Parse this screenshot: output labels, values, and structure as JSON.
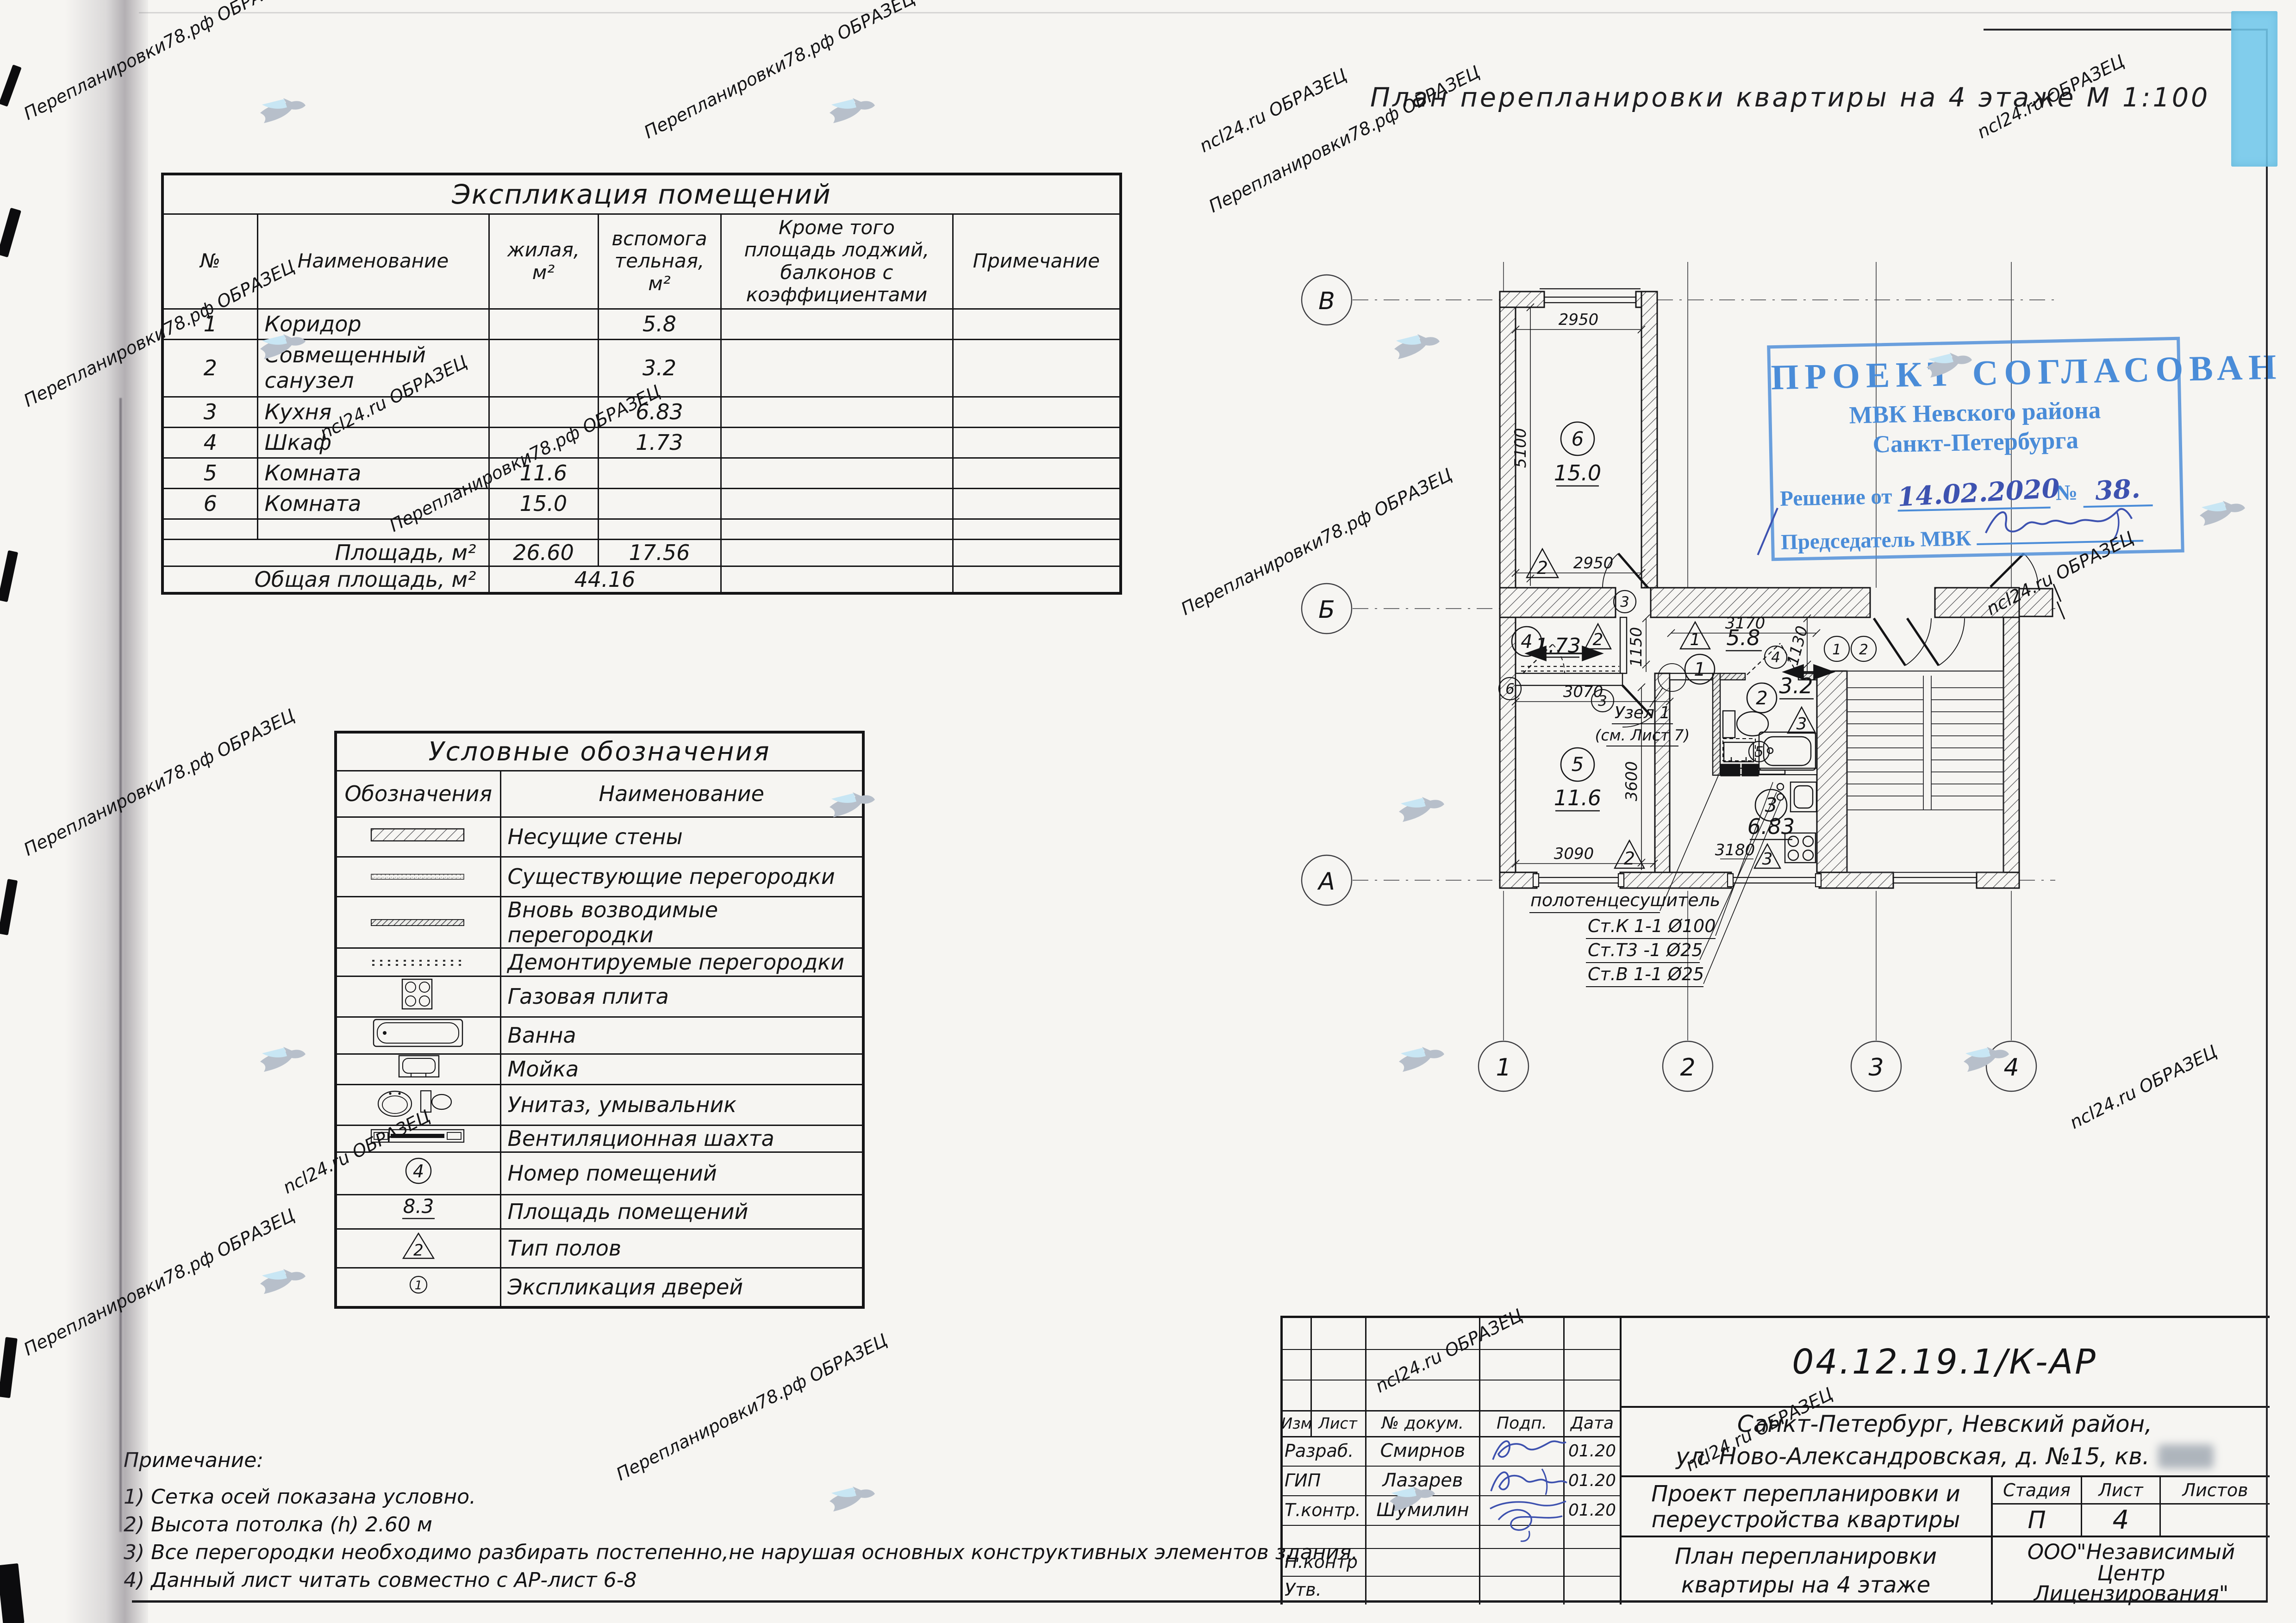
{
  "page": {
    "sheet_title": "План перепланировки квартиры на 4 этаже М 1:100"
  },
  "watermarks": {
    "a": "Перепланировки78.рф ОБРАЗЕЦ",
    "b": "ncl24.ru ОБРАЗЕЦ"
  },
  "explication": {
    "title": "Экспликация помещений",
    "headers": {
      "num": "№",
      "name": "Наименование",
      "living": "жилая,\nм²",
      "aux": "вспомога\nтельная,\nм²",
      "balcony": "Кроме того\nплощадь лоджий,\nбалконов с\nкоэффициентами",
      "note": "Примечание"
    },
    "rows": [
      {
        "num": "1",
        "name": "Коридор",
        "living": "",
        "aux": "5.8",
        "balcony": "",
        "note": ""
      },
      {
        "num": "2",
        "name": "Совмещенный\nсанузел",
        "living": "",
        "aux": "3.2",
        "balcony": "",
        "note": ""
      },
      {
        "num": "3",
        "name": "Кухня",
        "living": "",
        "aux": "6.83",
        "balcony": "",
        "note": ""
      },
      {
        "num": "4",
        "name": "Шкаф",
        "living": "",
        "aux": "1.73",
        "balcony": "",
        "note": ""
      },
      {
        "num": "5",
        "name": "Комната",
        "living": "11.6",
        "aux": "",
        "balcony": "",
        "note": ""
      },
      {
        "num": "6",
        "name": "Комната",
        "living": "15.0",
        "aux": "",
        "balcony": "",
        "note": ""
      }
    ],
    "subtotal": {
      "label": "Площадь, м²",
      "living": "26.60",
      "aux": "17.56"
    },
    "total": {
      "label": "Общая площадь, м²",
      "value": "44.16"
    }
  },
  "legend": {
    "title": "Условные обозначения",
    "headers": {
      "symbol": "Обозначения",
      "name": "Наименование"
    },
    "rows": [
      {
        "name": "Несущие стены"
      },
      {
        "name": "Существующие перегородки"
      },
      {
        "name": "Вновь возводимые перегородки"
      },
      {
        "name": "Демонтируемые перегородки"
      },
      {
        "name": "Газовая плита"
      },
      {
        "name": "Ванна"
      },
      {
        "name": "Мойка"
      },
      {
        "name": "Унитаз, умывальник"
      },
      {
        "name": "Вентиляционная шахта"
      },
      {
        "name": "Номер помещений"
      },
      {
        "name": "Площадь помещений"
      },
      {
        "name": "Тип полов"
      },
      {
        "name": "Экспликация дверей"
      }
    ],
    "symbol_labels": {
      "room_number": "4",
      "area": "8.3",
      "floor_type": "2",
      "door": "1"
    }
  },
  "notes": {
    "title": "Примечание:",
    "items": [
      "1)  Сетка осей показана условно.",
      "2)  Высота потолка (h) 2.60 м",
      "3)  Все перегородки необходимо разбирать постепенно,не нарушая основных конструктивных элементов здания.",
      "4)  Данный лист читать совместно с АР-лист 6-8"
    ]
  },
  "stamp": {
    "line1": "ПРОЕКТ СОГЛАСОВАН",
    "line2": "МВК Невского района",
    "line3": "Санкт-Петербурга",
    "decision_label": "Решение от",
    "decision_date": "14.02.2020",
    "number_label": "№",
    "number_value": "38.",
    "chairman_label": "Председатель МВК"
  },
  "titleblock": {
    "code": "04.12.19.1/К-АР",
    "address_line1": "Санкт-Петербург,  Невский  район,",
    "address_line2": "ул.  Ново-Александровская,  д.  №15,  кв.",
    "cols": {
      "izm": "Изм",
      "list": "Лист",
      "doc": "№ докум.",
      "sign": "Подп.",
      "date": "Дата"
    },
    "rows": [
      {
        "role": "Разраб.",
        "name": "Смирнов",
        "date": "01.20"
      },
      {
        "role": "ГИП",
        "name": "Лазарев",
        "date": "01.20"
      },
      {
        "role": "Т.контр.",
        "name": "Шумилин",
        "date": "01.20"
      },
      {
        "role": "Н.контр",
        "name": "",
        "date": ""
      },
      {
        "role": "Утв.",
        "name": "",
        "date": ""
      }
    ],
    "project_title1": "Проект перепланировки и",
    "project_title2": "переустройства квартиры",
    "sheet_name1": "План перепланировки",
    "sheet_name2": "квартиры на 4 этаже",
    "stage_label": "Стадия",
    "sheet_label": "Лист",
    "sheets_label": "Листов",
    "stage": "П",
    "sheet_num": "4",
    "sheets_num": "",
    "org_line1": "ООО\"Независимый",
    "org_line2": "Центр",
    "org_line3": "Лицензирования\""
  },
  "plan": {
    "axes": {
      "h1": "В",
      "h2": "Б",
      "h3": "А",
      "v1": "1",
      "v2": "2",
      "v3": "3",
      "v4": "4"
    },
    "rooms": {
      "r6": {
        "n": "6",
        "area": "15.0",
        "floor": "2"
      },
      "r4": {
        "n": "4",
        "area": "1.73",
        "floor": "2"
      },
      "r5": {
        "n": "5",
        "area": "11.6",
        "floor": "2"
      },
      "r1": {
        "n": "1",
        "area": "5.8",
        "floor": "1"
      },
      "r2": {
        "n": "2",
        "area": "3.2",
        "floor": "3"
      },
      "r3": {
        "n": "3",
        "area": "6.83",
        "floor": "3"
      }
    },
    "doors": {
      "room6": "3",
      "room5": "3",
      "shkaf": "6",
      "bath": "4",
      "wash": "5",
      "entry1": "1",
      "entry2": "2"
    },
    "dims": {
      "room6_top": "2950",
      "room6_left": "5100",
      "room6_bottom": "2950",
      "shkaf_w": "3070",
      "room5_w": "3090",
      "room5_h": "3600",
      "hall_w": "3170",
      "hall_left": "1150",
      "hall_right": "1130",
      "kitchen_w": "3180"
    },
    "ann": {
      "uzel1": "Узел 1",
      "uzel2": "(см. Лист 7)",
      "towel": "полотенцесушитель",
      "riser1": "Ст.К 1-1  Ø100",
      "riser2": "Ст.Т3 -1  Ø25",
      "riser3": "Ст.В 1-1  Ø25"
    }
  }
}
